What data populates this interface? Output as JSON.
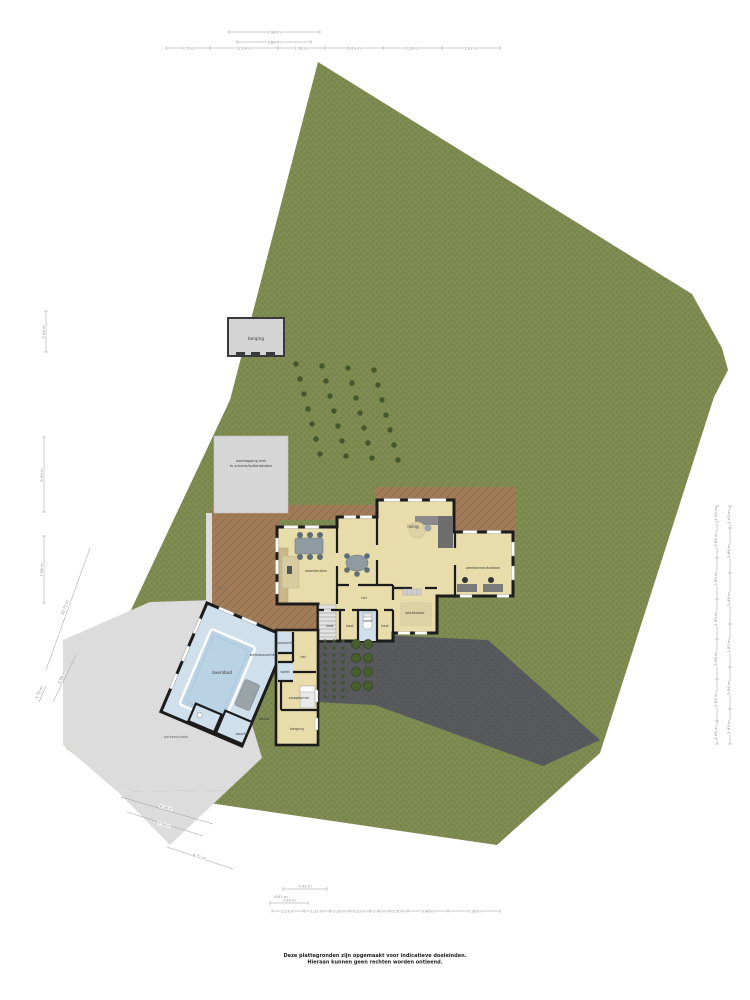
{
  "disclaimer": {
    "line1": "Deze plattegronden zijn opgemaakt voor indicatieve doeleinden.",
    "line2": "Hieraan kunnen geen rechten worden ontleend."
  },
  "labels": {
    "shed": "berging",
    "canopy_line1": "overkapping met",
    "canopy_line2": "tv scherm/buitenkeuken",
    "living": "living",
    "office": "werkkamer/kantoor",
    "kitchen": "woonkeuken",
    "hall": "hal",
    "study": "werkkamer",
    "closet1": "kast",
    "closet2": "kast",
    "closet3": "kast",
    "toilet": "toilet",
    "laundry": "wasruimte",
    "pool_hall": "hal",
    "pool_toilet": "toilet",
    "bedroom": "slaapkamer",
    "pool_storage": "berging",
    "pool": "zwembad",
    "wellness": "wellnessruimte",
    "sauna": "sauna",
    "shower": "douche",
    "driveway_note": "oprit",
    "parking_note": "parkeerplaats"
  },
  "dims": {
    "top_upper": [
      "7.98 m",
      "3.60 m"
    ],
    "top_chain": [
      "4.71 m",
      "12.04 m",
      "1.38 m",
      "6.09 m",
      "7.28 m",
      "1.92 m"
    ],
    "left": [
      "3.08 m",
      "8.00 m",
      "7.56 m"
    ],
    "left_diag": [
      "10.71 m",
      "6.88 m",
      "1.35 m"
    ],
    "right_a": [
      "1.05 m",
      "3.85 m",
      "2.93 m",
      "1.93 m",
      "3.06 m",
      "2.87 m",
      "1.43 m"
    ],
    "right_b": [
      "1.43 m",
      "3.66 m",
      "5.48 m",
      "2.87 m",
      "3.06 m",
      "1.93 m"
    ],
    "bottom_left_diag": [
      "9.06 m",
      "7.56 m",
      "6.71 m"
    ],
    "bottom_rows": [
      "4.42 m",
      "8.01 m",
      "3.29 m"
    ],
    "bottom_chain": [
      "2.21 m",
      "1.32 m",
      "1.20 m",
      "1.23 m",
      "1.40 m",
      "1.50 m",
      "3.46 m",
      "7.16 m"
    ]
  },
  "colors": {
    "grass": "#7d8a50",
    "grass_dark": "#6f7c46",
    "grass_light": "#8a975c",
    "terrace": "#a27c58",
    "terrace_dark": "#8d6a4a",
    "driveway": "#57595c",
    "driveway_dark": "#4e5053",
    "path": "#dcdcdc",
    "building": "#d4d4d4",
    "floor": "#e8dcab",
    "wall": "#1c1c1c",
    "pool_floor": "#cfe0ec",
    "pool_water": "#b9d2e4",
    "bush": "#44582c"
  }
}
